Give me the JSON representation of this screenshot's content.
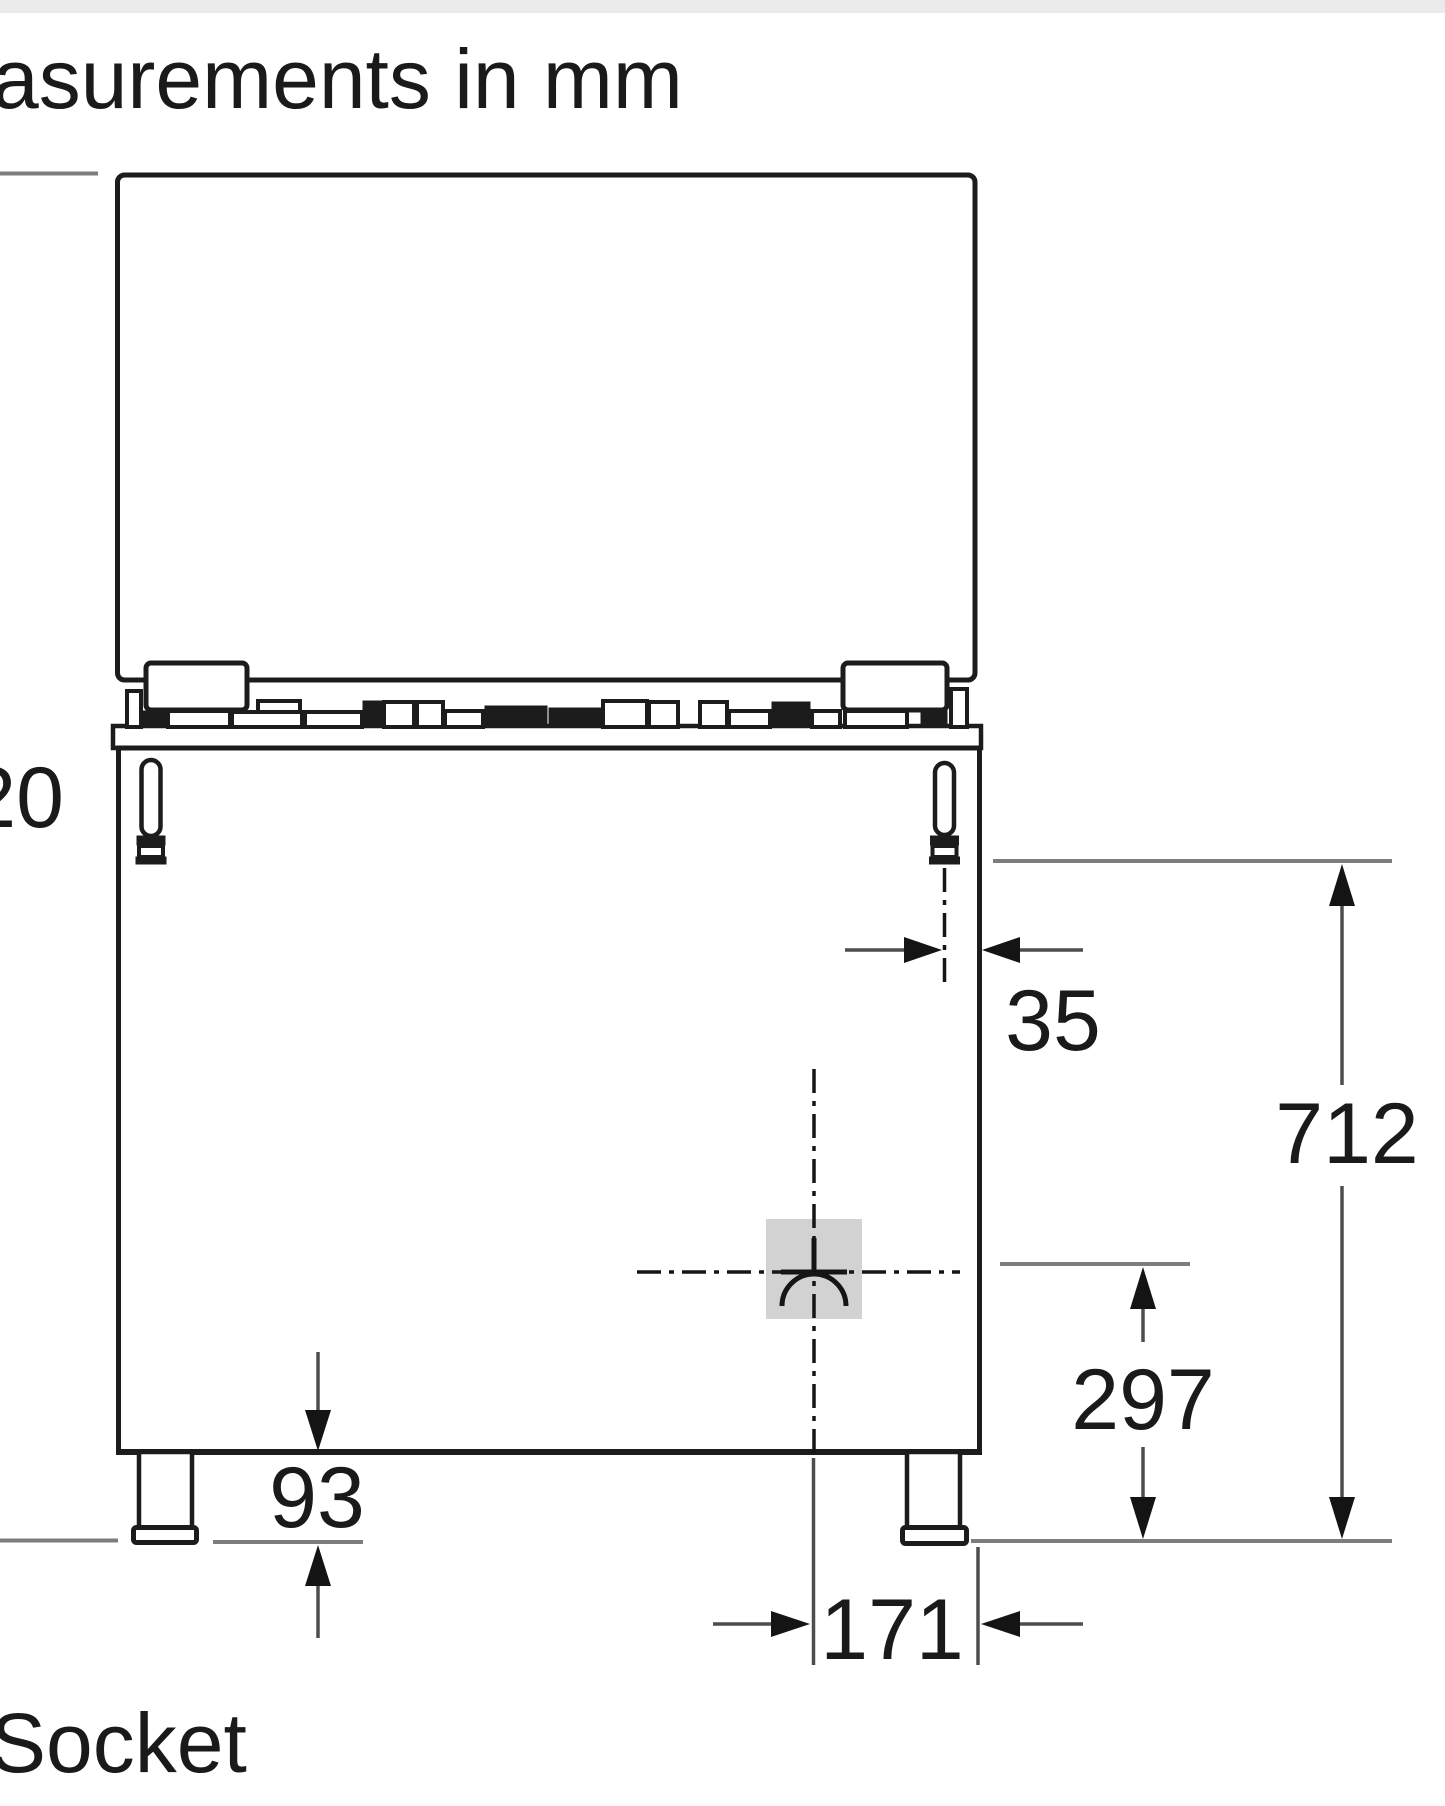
{
  "title": "asurements in mm",
  "socket_label": "Socket",
  "dims": {
    "d20": "20",
    "d35": "35",
    "d712": "712",
    "d297": "297",
    "d93": "93",
    "d171": "171"
  },
  "colors": {
    "line": "#1c1c1c",
    "dim_shaft": "#4d4d4d",
    "reference_gray": "#7d7d7d",
    "gas_symbol_fill": "#d2d2d2",
    "background": "#ffffff",
    "top_strip": "#ebebeb"
  },
  "icons": {
    "gas_connection": "gas-socket-symbol"
  }
}
